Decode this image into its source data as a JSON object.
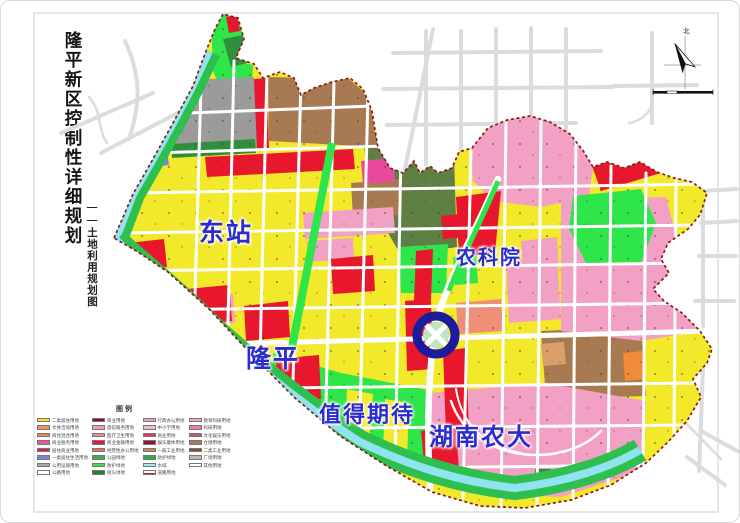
{
  "page": {
    "title": "隆平新区控制性详细规划",
    "subtitle": "——土地利用规划图"
  },
  "map": {
    "region_labels": [
      {
        "text": "东站",
        "left": 198,
        "top": 212,
        "size": 25
      },
      {
        "text": "农科院",
        "left": 455,
        "top": 240,
        "size": 20
      },
      {
        "text": "隆平",
        "left": 245,
        "top": 338,
        "size": 25
      },
      {
        "text": "值得期待",
        "left": 318,
        "top": 396,
        "size": 22
      },
      {
        "text": "湖南农大",
        "left": 428,
        "top": 416,
        "size": 24
      }
    ],
    "compass": {
      "north_label": "北"
    },
    "ring_marker": {
      "cx": 435,
      "cy": 334
    }
  },
  "palette": {
    "residential-yellow": "#f3e92b",
    "commercial-red": "#e8172e",
    "education-pink": "#f2a0c4",
    "deep-pink": "#e9499c",
    "industrial-brown": "#a87a52",
    "dark-brown": "#7a5236",
    "park-green": "#2ee54a",
    "olive-green": "#5e8044",
    "dark-green": "#2f8f3f",
    "river-cyan": "#8fe4ef",
    "station-grey": "#9b9b9b",
    "outer-road-grey": "#dcdcdc",
    "boundary-red": "#8b1a1a",
    "label-blue": "#2b2bd0",
    "ring-blue": "#1b1b9c",
    "salmon": "#ef8f7a",
    "violet": "#8080d8",
    "orange": "#ef8b3a"
  },
  "legend": {
    "title": "图例",
    "columns": [
      {
        "entries": [
          {
            "color": "#f3e92b",
            "label": "二类居住用地"
          },
          {
            "color": "#ef8f7a",
            "label": "文体活动用地"
          },
          {
            "color": "#ef8b3a",
            "label": "商住混合用地"
          },
          {
            "color": "#e957a8",
            "label": "商业服务用地"
          },
          {
            "color": "#d81f4e",
            "label": "居住商业用地"
          },
          {
            "color": "#8080d8",
            "label": "一类居住生活用地"
          },
          {
            "color": "#a8a8a8",
            "label": "公用设施用地"
          },
          {
            "color": "#ffffff",
            "label": "公路用地"
          }
        ]
      },
      {
        "entries": [
          {
            "color": "#8b1220",
            "label": "商业用地"
          },
          {
            "color": "#f1a0b4",
            "label": "旅馆服务用地"
          },
          {
            "color": "#ef8ba5",
            "label": "医疗卫生用地"
          },
          {
            "color": "#e41a30",
            "label": "商业金融用地"
          },
          {
            "color": "#e8705e",
            "label": "经营性办公用地"
          },
          {
            "color": "#35b44a",
            "label": "公园绿地"
          },
          {
            "color": "#3fe03f",
            "label": "防护绿地"
          },
          {
            "color": "#2e7d32",
            "label": "街头绿地"
          }
        ]
      },
      {
        "entries": [
          {
            "color": "#ef9ec2",
            "label": "行政办公用地"
          },
          {
            "color": "#f4b8cf",
            "label": "中小学用地"
          },
          {
            "color": "#e23a56",
            "label": "商业用地"
          },
          {
            "color": "#9c1030",
            "label": "娱乐康体用地"
          },
          {
            "color": "#c98a52",
            "label": "一般工业用地"
          },
          {
            "color": "#27ae45",
            "label": "防护绿地"
          },
          {
            "color": "#9fe8f0",
            "label": "水域"
          },
          {
            "color": "#ffffff",
            "label": "道路用地",
            "style": "road-line"
          }
        ]
      },
      {
        "entries": [
          {
            "color": "#f2a7c5",
            "label": "教育科研用地"
          },
          {
            "color": "#ee7fa8",
            "label": "科研用地"
          },
          {
            "color": "#c2547e",
            "label": "文化娱乐用地"
          },
          {
            "color": "#a8795a",
            "label": "仓储用地"
          },
          {
            "color": "#7a5236",
            "label": "二类工业用地"
          },
          {
            "color": "#b9b9b9",
            "label": "广场用地"
          },
          {
            "color": "#ffffff",
            "label": "其他用地"
          }
        ]
      }
    ]
  }
}
